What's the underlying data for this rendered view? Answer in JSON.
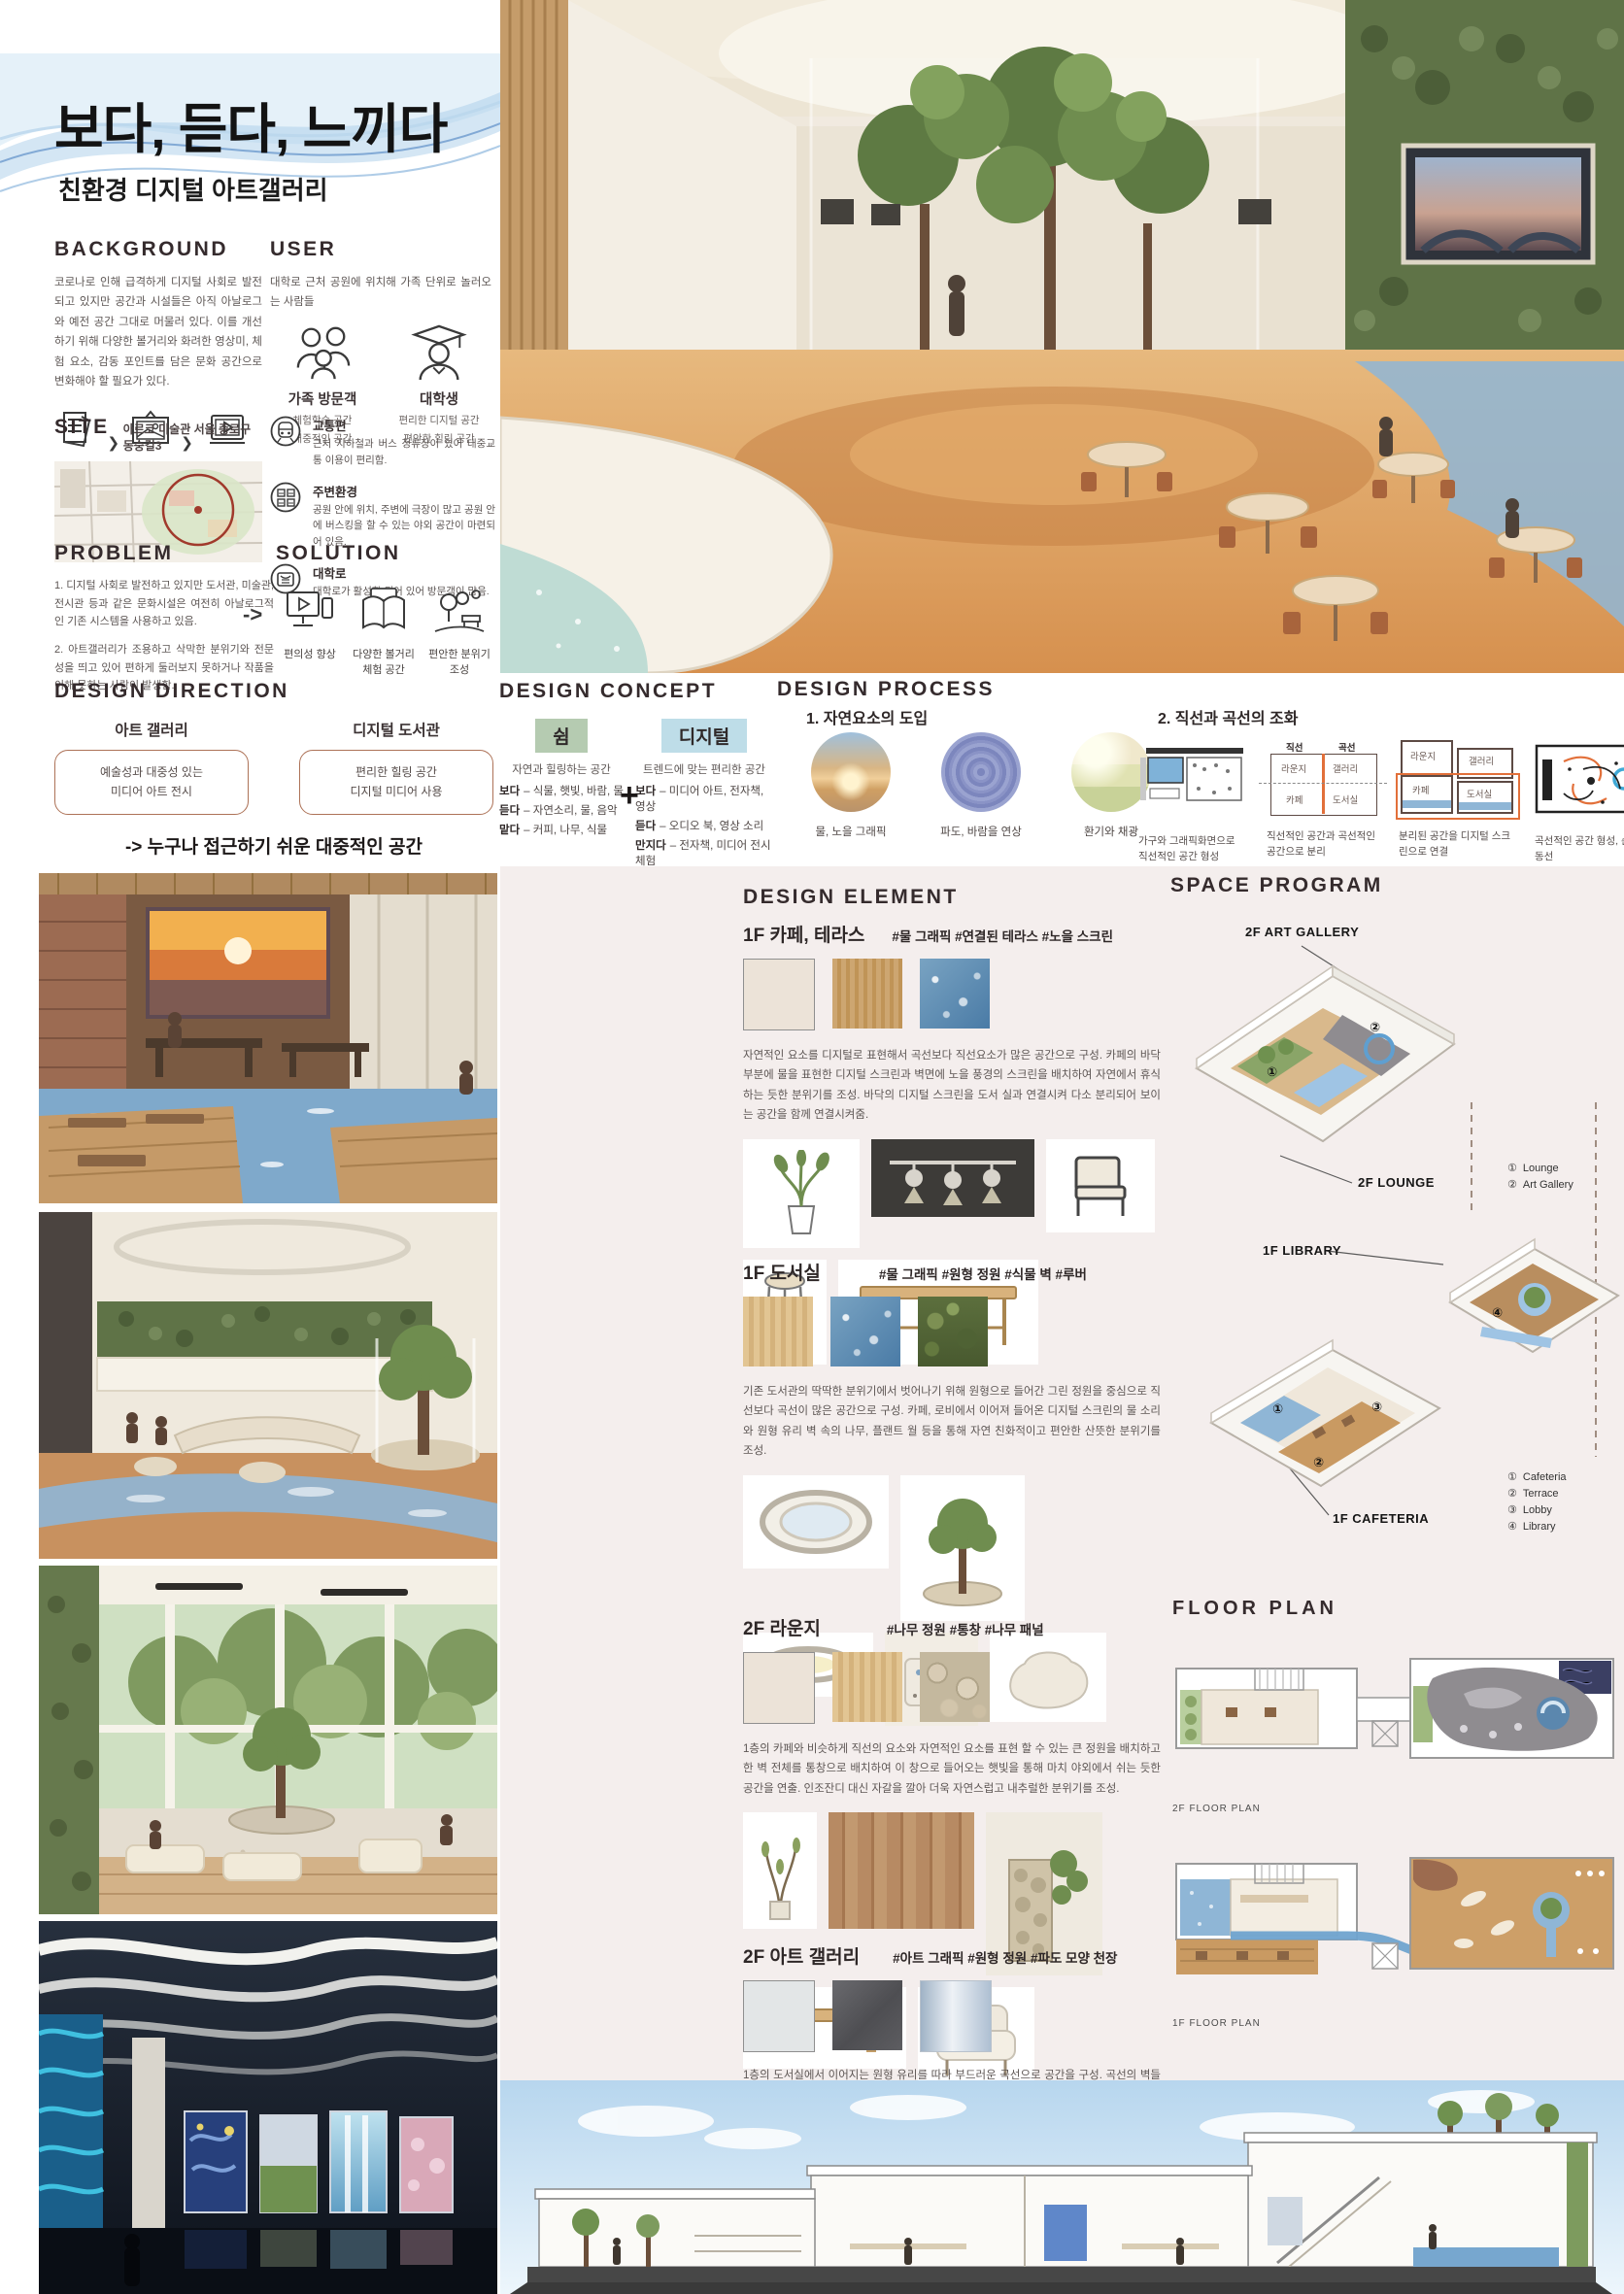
{
  "header": {
    "title": "보다, 듣다, 느끼다",
    "subtitle": "친환경 디지털 아트갤러리"
  },
  "background": {
    "heading": "BACKGROUND",
    "body": "코로나로 인해 급격하게 디지털 사회로 발전되고 있지만 공간과 시설들은 아직 아날로그와 예전 공간 그대로 머물러 있다. 이를 개선하기 위해 다양한 볼거리와 화려한 영상미, 체험 요소, 감동 포인트를 담은 문화 공간으로 변화해야 할 필요가 있다.",
    "arrow": "❯",
    "steps": [
      {
        "label": "글"
      },
      {
        "label": "그림"
      },
      {
        "label": "미디어 아트"
      }
    ]
  },
  "user": {
    "heading": "USER",
    "body": "대학로 근처 공원에 위치해 가족 단위로 놀러오는 사람들",
    "personas": [
      {
        "name": "가족 방문객",
        "trait1": "체험학습 공간",
        "trait2": "대중적인 공간"
      },
      {
        "name": "대학생",
        "trait1": "편리한 디지털 공간",
        "trait2": "편안한 힐링 공간"
      }
    ],
    "context": [
      {
        "title": "교통편",
        "desc": "근처 지하철과 버스 정류장이 있어 대중교통 이용이 편리함."
      },
      {
        "title": "주변환경",
        "desc": "공원 안에 위치, 주변에 극장이 많고 공원 안에 버스킹을 할 수 있는 야외 공간이 마련되어 있음."
      },
      {
        "title": "대학로",
        "desc": "대학로가 활성화 되어 있어 방문객이 많음."
      }
    ]
  },
  "site": {
    "heading": "SITE",
    "location": "아르코 미술관  서울 종로구 동숭길3"
  },
  "problem": {
    "heading": "PROBLEM",
    "item1": "1. 디지털 사회로 발전하고 있지만 도서관, 미술관, 전시관 등과 같은 문화시설은 여전히 아날로그적인 기존 시스템을 사용하고 있음.",
    "item2": "2. 아트갤러리가 조용하고 삭막한 분위기와 전문성을 띄고 있어 편하게 둘러보지 못하거나 작품을 이해 못하는 사람이 발생함."
  },
  "solution": {
    "heading": "SOLUTION",
    "arrow": "->",
    "items": [
      {
        "label": "편의성 향상"
      },
      {
        "label": "다양한 볼거리\n체험 공간"
      },
      {
        "label": "편안한 분위기\n조성"
      }
    ]
  },
  "design_direction": {
    "heading": "DESIGN DIRECTION",
    "col1": {
      "title": "아트 갤러리",
      "box": "예술성과 대중성 있는\n미디어 아트 전시"
    },
    "col2": {
      "title": "디지털 도서관",
      "box": "편리한 힐링 공간\n디지털 미디어 사용"
    },
    "conclusion": "-> 누구나 접근하기 쉬운 대중적인 공간"
  },
  "design_concept": {
    "heading": "DESIGN CONCEPT",
    "plus": "+",
    "left": {
      "tag": "쉼",
      "desc": "자연과 힐링하는 공간",
      "lines": [
        {
          "k": "보다",
          "v": "– 식물, 햇빛, 바람, 물"
        },
        {
          "k": "듣다",
          "v": "–  자연소리, 물, 음악"
        },
        {
          "k": "맡다",
          "v": "– 커피, 나무, 식물"
        }
      ]
    },
    "right": {
      "tag": "디지털",
      "desc": "트렌드에 맞는 편리한 공간",
      "lines": [
        {
          "k": "보다",
          "v": "– 미디어 아트, 전자책, 영상"
        },
        {
          "k": "듣다",
          "v": "–  오디오 북, 영상 소리"
        },
        {
          "k": "만지다",
          "v": "– 전자책, 미디어 전시체험"
        }
      ]
    }
  },
  "design_process": {
    "heading": "DESIGN PROCESS",
    "step1": {
      "title": "1. 자연요소의 도입",
      "captions": [
        "물, 노을 그래픽",
        "파도, 바람을 연상",
        "환기와 채광"
      ]
    },
    "step2": {
      "title": "2. 직선과 곡선의 조화",
      "labels": {
        "straight": "직선",
        "curve": "곡선",
        "lounge": "라운지",
        "gallery": "갤러리",
        "cafe": "카페",
        "library": "도서실"
      },
      "captions": [
        "가구와 그래픽화면으로\n직선적인 공간 형성",
        "직선적인 공간과 곡선적인\n공간으로 분리",
        "분리된 공간을 디지털 스크\n린으로 연결",
        "곡선적인 공간 형성, 순환\n동선"
      ]
    }
  },
  "design_element": {
    "heading": "DESIGN ELEMENT",
    "sections": [
      {
        "title": "1F 카페, 테라스",
        "tags": "#물 그래픽  #연결된 테라스  #노을 스크린",
        "desc": "자연적인 요소를 디지털로 표현해서 곡선보다 직선요소가 많은 공간으로 구성. 카페의 바닥 부분에 물을 표현한 디지털 스크린과 벽면에 노을 풍경의 스크린을 배치하여 자연에서 휴식하는 듯한 분위기를 조성. 바닥의 디지털 스크린을 도서 실과 연결시켜 다소 분리되어 보이는 공간을 함께 연결시켜줌."
      },
      {
        "title": "1F 도서실",
        "tags": "#물 그래픽  #원형 정원  #식물 벽  #루버",
        "desc": "기존 도서관의 딱딱한 분위기에서 벗어나기 위해 원형으로 들어간 그린 정원을 중심으로 직선보다 곡선이 많은 공간으로 구성. 카페, 로비에서 이어져 들어온 디지털 스크린의 물 소리와 원형 유리 벽 속의 나무, 플랜트 월 등을 통해 자연 친화적이고 편안한 산뜻한 분위기를 조성."
      },
      {
        "title": "2F 라운지",
        "tags": "#나무 정원  #통창 #나무 패널",
        "desc": "1층의 카페와 비슷하게 직선의 요소와 자연적인 요소를 표현 할 수 있는 큰 정원을 배치하고 한 벽 전체를 통창으로 배치하여 이 창으로 들어오는 햇빛을 통해 마치 야외에서 쉬는 듯한 공간을 연출. 인조잔디 대신 자갈을 깔아 더욱 자연스럽고 내추럴한 분위기를 조성."
      },
      {
        "title": "2F 아트 갤러리",
        "tags": "#아트 그래픽  #원형 정원 #파도 모양 천장",
        "desc": "1층의 도서실에서 이어지는 원형 유리를 따라 부드러운 곡선으로 공간을 구성. 곡선의 벽들을 따라 미디어 아트와 체험형 미디어 스크린 아트를 전시, 사용자의 움직임에 따라 움직이는 체험형 터치스크린을 바닥과 벽에 설치하고 원형 유리월은 그래픽 화면들이 투명하게 보이도록 설치함."
      }
    ]
  },
  "space_program": {
    "heading": "SPACE PROGRAM",
    "labels": {
      "gallery": "2F ART GALLERY",
      "lounge": "2F LOUNGE",
      "library": "1F LIBRARY",
      "cafeteria": "1F CAFETERIA"
    },
    "legend_2f": [
      {
        "num": "①",
        "label": "Lounge"
      },
      {
        "num": "②",
        "label": "Art Gallery"
      }
    ],
    "legend_1f": [
      {
        "num": "①",
        "label": "Cafeteria"
      },
      {
        "num": "②",
        "label": "Terrace"
      },
      {
        "num": "③",
        "label": "Lobby"
      },
      {
        "num": "④",
        "label": "Library"
      }
    ]
  },
  "floor_plan": {
    "heading": "FLOOR PLAN",
    "label_2f": "2F FLOOR PLAN",
    "label_1f": "1F FLOOR PLAN"
  },
  "colors": {
    "concept_green": "#b5cbb1",
    "concept_blue": "#bedde8",
    "diagram_orange": "#e2703a",
    "water_blue": "#5b87ae",
    "wood_tan": "#c9a06b",
    "panel_pink": "#f4eeed",
    "heading_dark": "#352b2d"
  }
}
